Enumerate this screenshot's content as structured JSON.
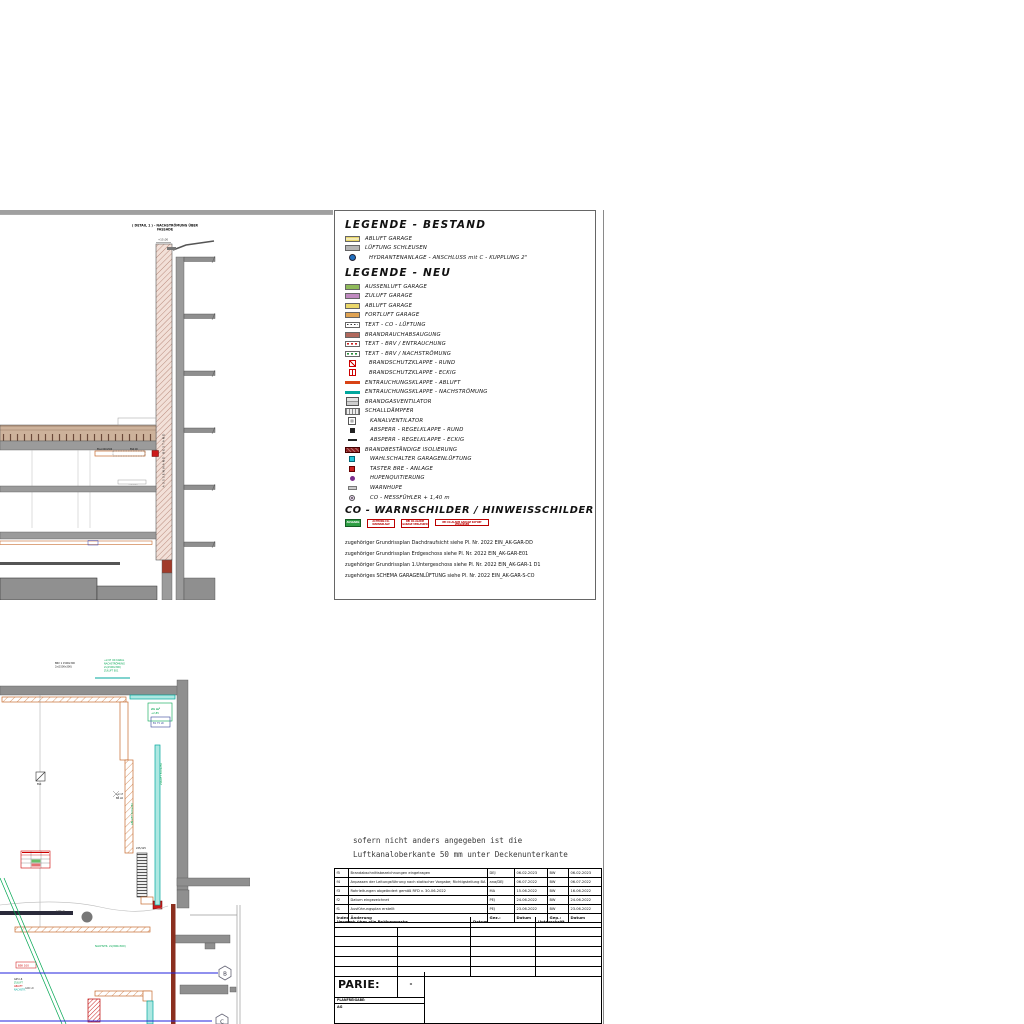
{
  "colors": {
    "duct_orange": "#c76b2e",
    "duct_teal": "#00a79d",
    "annotation_green": "#00a651",
    "grid_blue": "#2222dd",
    "alarm_red": "#cc1a1a",
    "wall_gray": "#8f8f8f",
    "wall_darkred": "#8b2f1f",
    "hatch_pink": "#c9a396",
    "hydrant_blue": "#1f6fbf"
  },
  "legend": {
    "bestand_title": "LEGENDE - BESTAND",
    "bestand": [
      {
        "label": "ABLUFT GARAGE"
      },
      {
        "label": "LÜFTUNG SCHLEUSEN"
      },
      {
        "label": "HYDRANTENANLAGE - ANSCHLUSS mit C - KUPPLUNG 2\""
      }
    ],
    "neu_title": "LEGENDE - NEU",
    "neu": [
      {
        "label": "AUSSENLUFT GARAGE"
      },
      {
        "label": "ZULUFT GARAGE"
      },
      {
        "label": "ABLUFT GARAGE"
      },
      {
        "label": "FORTLUFT GARAGE"
      },
      {
        "label": "TEXT - CO - LÜFTUNG"
      },
      {
        "label": "BRANDRAUCHABSAUGUNG"
      },
      {
        "label": "TEXT - BRV / ENTRAUCHUNG"
      },
      {
        "label": "TEXT - BRV / NACHSTRÖMUNG"
      },
      {
        "label": "BRANDSCHUTZKLAPPE - RUND"
      },
      {
        "label": "BRANDSCHUTZKLAPPE - ECKIG"
      },
      {
        "label": "ENTRAUCHUNGSKLAPPE - ABLUFT"
      },
      {
        "label": "ENTRAUCHUNGSKLAPPE - NACHSTRÖMUNG"
      },
      {
        "label": "BRANDGASVENTILATOR"
      },
      {
        "label": "SCHALLDÄMPFER"
      },
      {
        "label": "KANALVENTILATOR"
      },
      {
        "label": "ABSPERR - REGELKLAPPE - RUND"
      },
      {
        "label": "ABSPERR - REGELKLAPPE - ECKIG"
      },
      {
        "label": "BRANDBESTÄNDIGE ISOLIERUNG"
      },
      {
        "label": "WAHLSCHALTER GARAGENLÜFTUNG"
      },
      {
        "label": "TASTER BRE - ANLAGE"
      },
      {
        "label": "HUPENQUITIERUNG"
      },
      {
        "label": "WARNHUPE"
      },
      {
        "label": "CO - MESSFÜHLER + 1,40 m"
      }
    ],
    "co_title": "CO - WARNSCHILDER / HINWEISSCHILDER",
    "signs": [
      {
        "label": "AUSGANG"
      },
      {
        "label": "ACHTUNG CO-WARNANLAGE"
      },
      {
        "label": "BEI CO-ALARM GARAGE VERLASSEN"
      },
      {
        "label": "BEI CO-ALARM GARAGE SOFORT VERLASSEN"
      }
    ],
    "references": [
      "zugehöriger Grundrissplan Dachdraufsicht siehe Pl. Nr. 2022 EIN_AK-GAR-DD",
      "zugehöriger Grundrissplan Erdgeschoss siehe Pl. Nr. 2022 EIN_AK-GAR-E01",
      "zugehöriger Grundrissplan 1.Untergeschoss siehe Pl. Nr. 2022 EIN_AK-GAR-1 D1",
      "zugehöriges SCHEMA GARAGENLÜFTUNG siehe Pl. Nr. 2022 EIN_AK-GAR-S-CO"
    ]
  },
  "note": {
    "line1": "sofern nicht anders angegeben ist die",
    "line2": "Luftkanaloberkante 50 mm unter Deckenunterkante"
  },
  "section": {
    "title1": "( DETAIL 1 ) - NACHSTRÖMUNG ÜBER",
    "title2": "FASSADE",
    "level": "+15,00",
    "wall_label": "AUSSENWAND BESTAND",
    "duct_label1": "EK-A 600x300",
    "duct_label2": "BSK 90",
    "duct_label3": "400x200"
  },
  "plan": {
    "black_note1": "BRV 1  1500x300",
    "black_note2": "2x(1500x300)",
    "green_note1": "+2,97 OK KANAL",
    "green_note2": "NACHSTRÖMUNG",
    "green_note3": "2x(1500x300)",
    "green_note4": "ZULUFT E01",
    "area1": "21 m²",
    "area2": "+2,85",
    "area3": "B1 75 LR",
    "lbl_g08": "G08 LR",
    "lbl_g06": "G06 LR",
    "lbl_217": "+2,17",
    "lbl_brlr": "BR LR",
    "lbl_duct": "225/125",
    "lbl_bsk": "BSK",
    "green_abluft": "ABLUFT 500x250",
    "green_zuluft": "ZULUFT 500x250",
    "green_nach": "NACHSTR. 2x(800x300)",
    "red_bsk": "BSK 100",
    "multi1": "G05 LR",
    "multi2": "ZULUFT",
    "multi3": "ABLUFT",
    "multi4": "NACHSTR.",
    "grid_b": "B",
    "grid_c": "C"
  },
  "titleblock": {
    "revisions": [
      {
        "idx": "f5",
        "text": "Brandabschnittsbezeichnungen eingetragen",
        "gez": "DEJ",
        "d1": "06.02.2023",
        "gep": "BW",
        "d2": "06.02.2023"
      },
      {
        "idx": "f4",
        "text": "Anpassen der Leitungsführung nach statischer Vorgabe; Richtigstellung BA",
        "gez": "ana/DEJ",
        "d1": "06.07.2022",
        "gep": "BW",
        "d2": "06.07.2022"
      },
      {
        "idx": "f3",
        "text": "Rohrleitungen abgeändert gemäß RFD v. 30-06-2022",
        "gez": "MA",
        "d1": "15.06.2022",
        "gep": "BW",
        "d2": "16.06.2022"
      },
      {
        "idx": "f2",
        "text": "Datum eingezeichnet",
        "gez": "PEJ",
        "d1": "24.06.2022",
        "gep": "BW",
        "d2": "24.06.2022"
      },
      {
        "idx": "f1",
        "text": "Ausführungsplan erstellt",
        "gez": "PEJ",
        "d1": "23.06.2022",
        "gep": "BW",
        "d2": "23.06.2022"
      }
    ],
    "footer": {
      "idx": "Index",
      "text": "Änderung",
      "gez": "Gez.:",
      "d1": "Datum",
      "gep": "Gep.:",
      "d2": "Datum"
    },
    "check": {
      "title": "Vermerk über alle Prüfvermerke",
      "datum": "Datum",
      "vermerk": "Unterschrift"
    },
    "partie_label": "PARIE:",
    "partie_value": "-",
    "planfreigabe": "PLANFREIGABE:",
    "ag": "AG"
  }
}
